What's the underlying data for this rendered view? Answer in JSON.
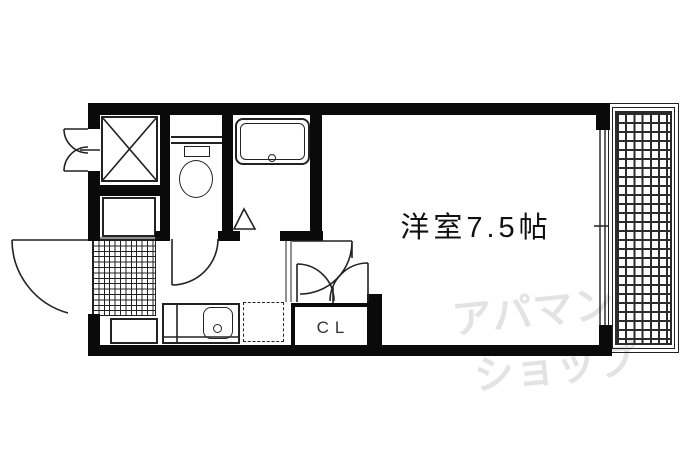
{
  "plan": {
    "main_room_label": "洋室7.5帖",
    "closet_label": "CL"
  },
  "watermark": {
    "line1": "アパマン",
    "line2": "ショップ"
  },
  "colors": {
    "wall": "#0a0a0a",
    "line": "#222222",
    "watermark": "#e3e3e3",
    "background": "#ffffff"
  },
  "fixtures": [
    "washing-machine-space",
    "washbasin-space",
    "toilet",
    "bathtub",
    "bath-folding-door",
    "service-hatch-double-doors",
    "entrance-door",
    "entrance-tile",
    "shoe-cabinet",
    "kitchen-counter-sink",
    "refrigerator-space",
    "toilet-door",
    "room-door",
    "closet-double-doors",
    "window",
    "balcony"
  ]
}
